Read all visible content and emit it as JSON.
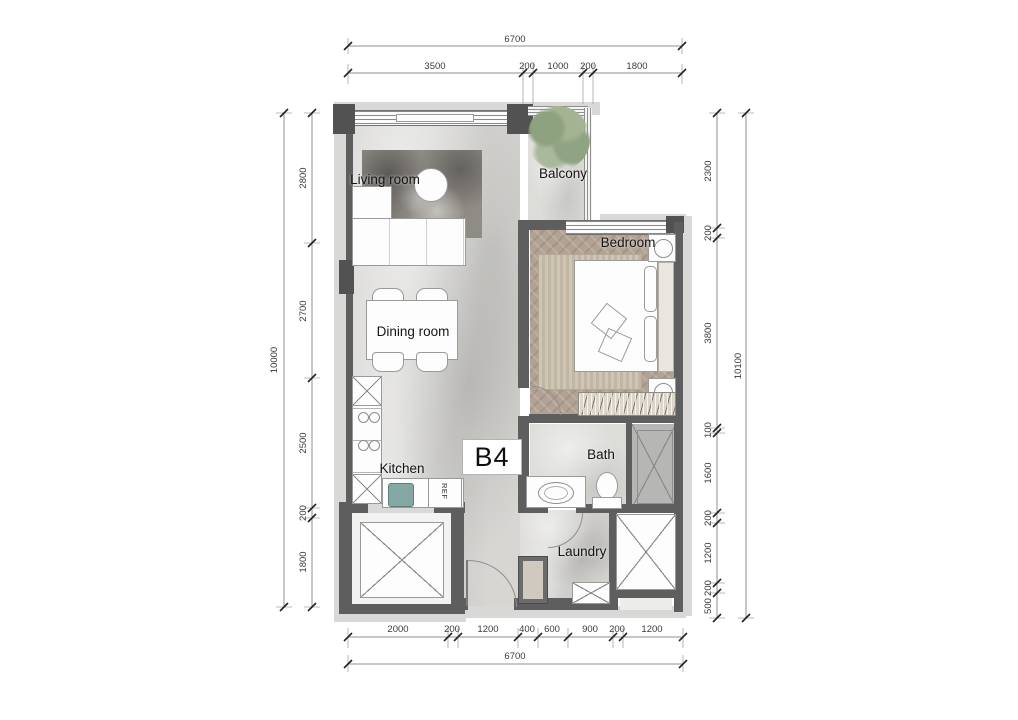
{
  "plan": {
    "unit_label": "B4",
    "rooms": {
      "living": "Living room",
      "balcony": "Balcony",
      "bedroom": "Bedroom",
      "dining": "Dining room",
      "kitchen": "Kitchen",
      "bath": "Bath",
      "laundry": "Laundry"
    },
    "labels": {
      "refrigerator": "REF"
    }
  },
  "dimensions": {
    "top": {
      "total": "6700",
      "segments": [
        "3500",
        "200",
        "1000",
        "200",
        "1800"
      ]
    },
    "bottom": {
      "total": "6700",
      "segments": [
        "2000",
        "200",
        "1200",
        "400",
        "600",
        "900",
        "200",
        "1200"
      ]
    },
    "left": {
      "total": "10000",
      "segments": [
        "2800",
        "2700",
        "2500",
        "200",
        "1800"
      ]
    },
    "right": {
      "total": "10100",
      "segments": [
        "2300",
        "200",
        "3800",
        "100",
        "1600",
        "200",
        "1200",
        "200",
        "500"
      ]
    }
  },
  "colors": {
    "wall": "#5e5e5e",
    "floor": "#d7d6d3",
    "bedroom_floor": "#b2a294",
    "plant": "#8ea27f",
    "dimension_text": "#3a3a3a"
  }
}
